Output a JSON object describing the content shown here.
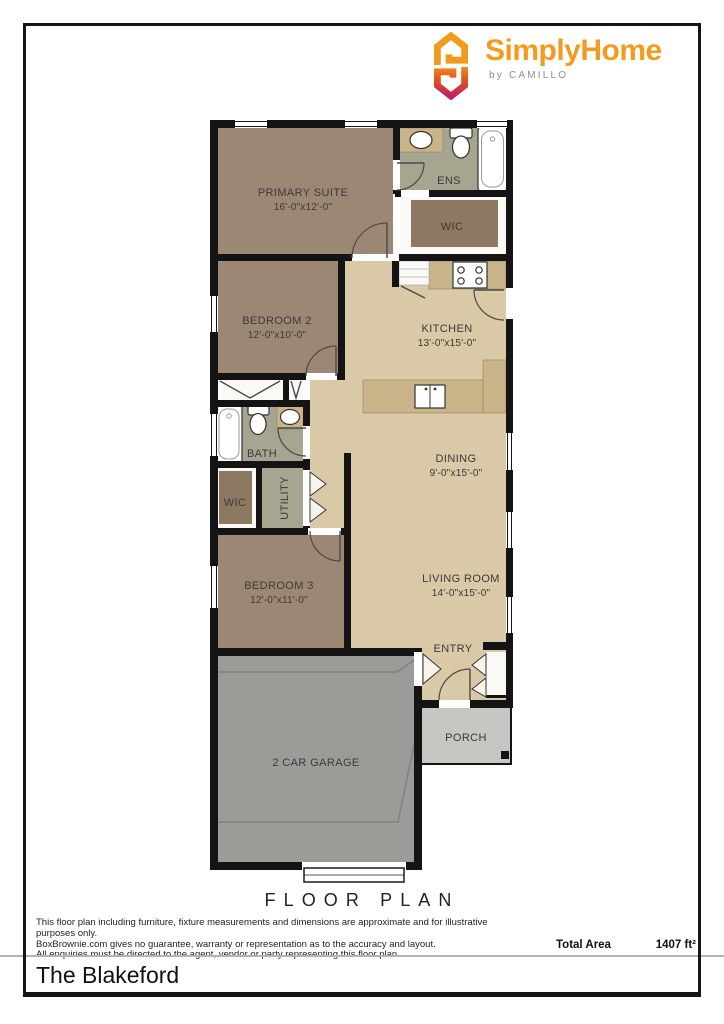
{
  "logo": {
    "brand": "SimplyHome",
    "byline": "by CAMILLO",
    "brand_color": "#F49B1F",
    "icon_gradient_bottom": "#BE2168"
  },
  "plan": {
    "rooms": {
      "primary_suite": {
        "name": "PRIMARY SUITE",
        "dims": "16'-0\"x12'-0\""
      },
      "ens": {
        "name": "ENS"
      },
      "wic1": {
        "name": "WIC"
      },
      "bedroom2": {
        "name": "BEDROOM 2",
        "dims": "12'-0\"x10'-0\""
      },
      "kitchen": {
        "name": "KITCHEN",
        "dims": "13'-0\"x15'-0\""
      },
      "bath": {
        "name": "BATH"
      },
      "wic2": {
        "name": "WIC"
      },
      "utility": {
        "name": "UTILITY"
      },
      "dining": {
        "name": "DINING",
        "dims": "9'-0\"x15'-0\""
      },
      "bedroom3": {
        "name": "BEDROOM 3",
        "dims": "12'-0\"x11'-0\""
      },
      "living_room": {
        "name": "LIVING ROOM",
        "dims": "14'-0\"x15'-0\""
      },
      "entry": {
        "name": "ENTRY"
      },
      "garage": {
        "name": "2 CAR GARAGE"
      },
      "porch": {
        "name": "PORCH"
      }
    },
    "colors": {
      "wall": "#141414",
      "bedroom_floor": "#9c8774",
      "open_floor": "#d9c9a6",
      "wet_floor": "#a7a48f",
      "counter": "#c9b388",
      "rug": "#8d7961",
      "garage_floor": "#9c9b98",
      "porch_floor": "#c7c6c3"
    }
  },
  "footer": {
    "heading": "FLOOR PLAN",
    "disclaimer_line1": "This floor plan including furniture, fixture measurements and dimensions are approximate and for illustrative purposes only.",
    "disclaimer_line2": "BoxBrownie.com gives no guarantee, warranty or representation as to the accuracy and layout.",
    "disclaimer_line3": "All enquiries must be directed to the agent, vendor or party representing this floor plan.",
    "total_area_label": "Total Area",
    "total_area_value": "1407 ft²"
  },
  "title_bar": {
    "name": "The Blakeford"
  }
}
